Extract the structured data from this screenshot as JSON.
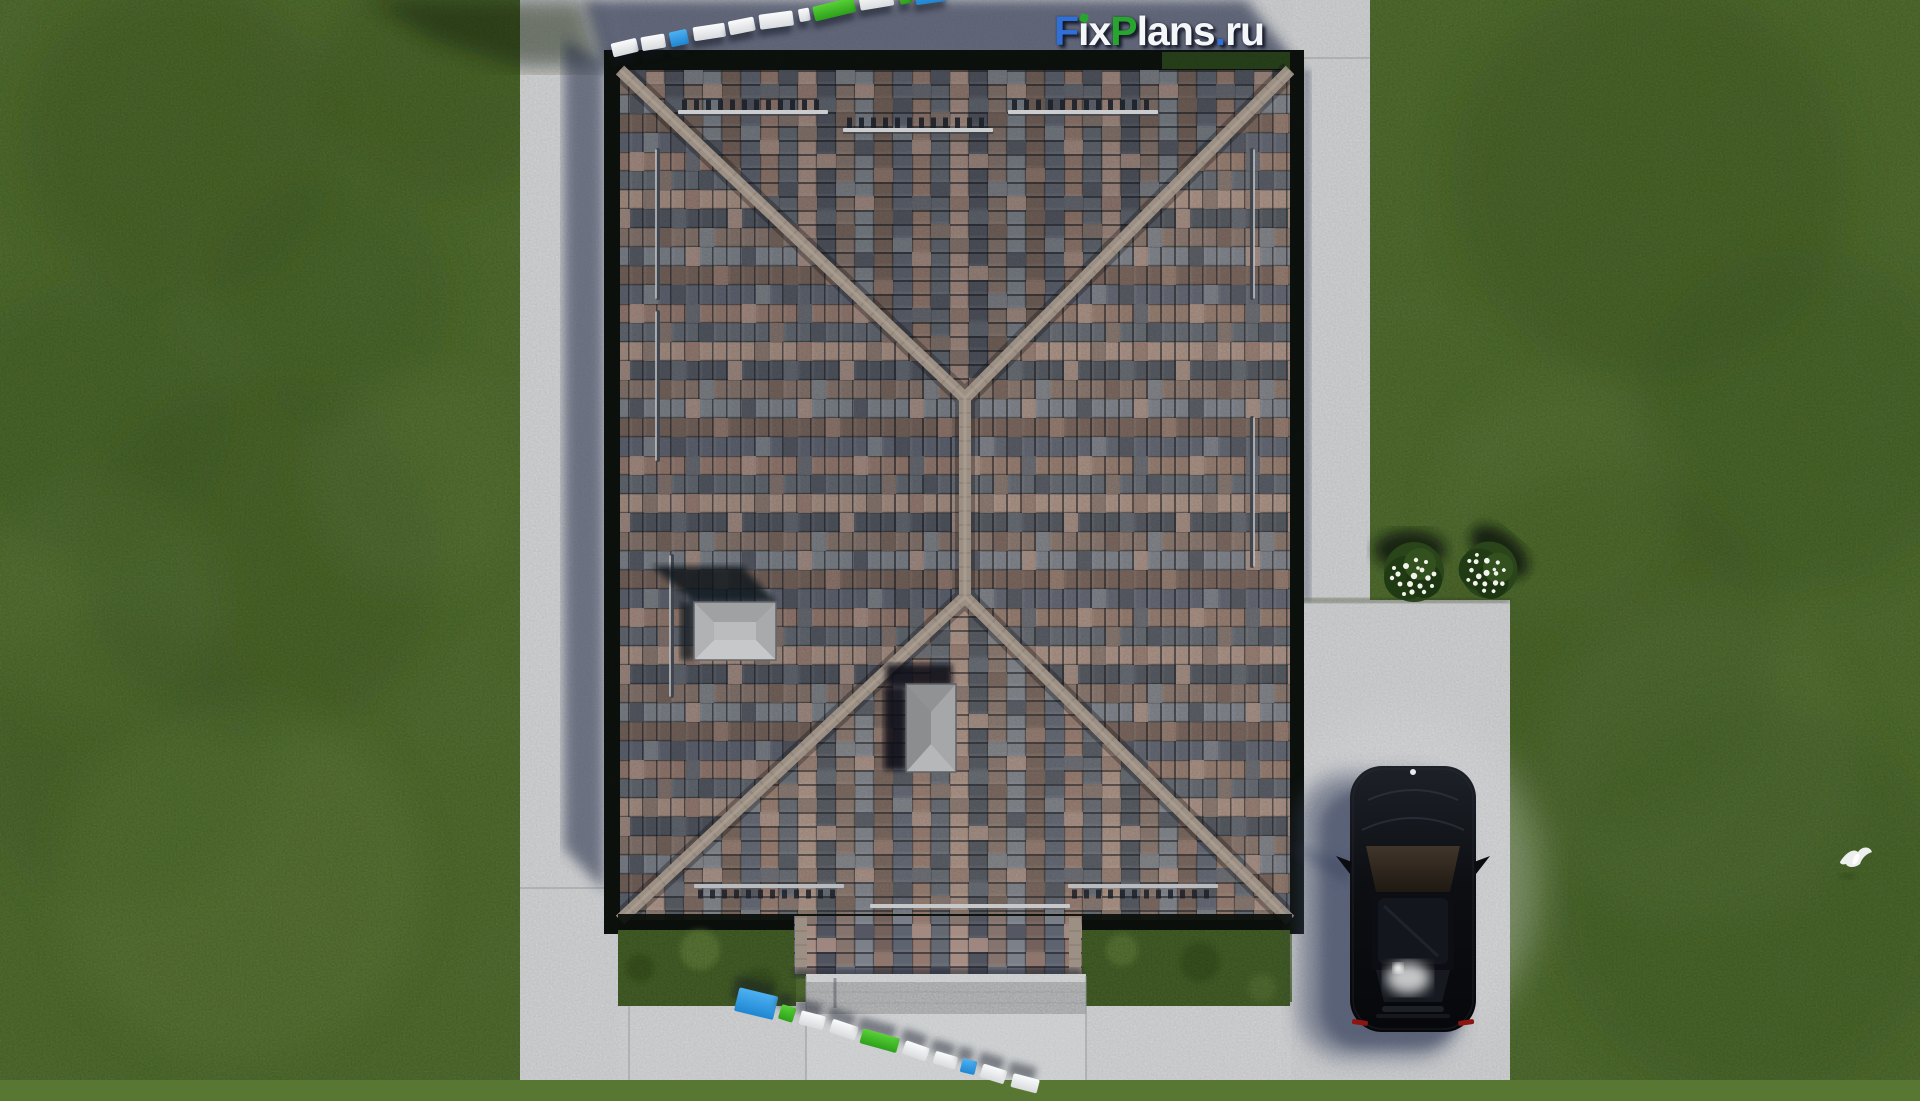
{
  "brand": {
    "logo_full_text": "FixPlans.ru",
    "logo_segments": [
      {
        "t": "F",
        "c": "#2f6fd8"
      },
      {
        "t": "i",
        "c": "#f4f6f8",
        "dot": "#27a62e"
      },
      {
        "t": "x",
        "c": "#f4f6f8"
      },
      {
        "t": "P",
        "c": "#27a62e"
      },
      {
        "t": "lans",
        "c": "#f4f6f8"
      },
      {
        "t": ".",
        "c": "#2f6fd8"
      },
      {
        "t": "ru",
        "c": "#f4f6f8"
      }
    ]
  },
  "palette": {
    "grass": "#587733",
    "grass_dark": "#3f5c24",
    "grass_light": "#6d8d45",
    "concrete": "#cdcfd1",
    "concrete_shadow": "#596078",
    "roof_ridge": "#9c9085",
    "roof_tiles": [
      "#9b7f73",
      "#696e76",
      "#b0968a",
      "#555962",
      "#8d7a71",
      "#848890",
      "#7b675e",
      "#646975"
    ],
    "car_body": "#0b0d11",
    "bar_blue": "#2f9fe8",
    "bar_green": "#47c32a",
    "bar_white": "#eef0f2"
  },
  "scene": {
    "view": "top-down aerial render of hip-roof house with driveway, lawn, parked black car, two flowering bushes, flying bird",
    "scale_bar_top": {
      "x": 612,
      "y": 38,
      "angle": -10.5,
      "gap": 4,
      "blocks": [
        {
          "c": "white",
          "w": 26,
          "h": 14
        },
        {
          "c": "white",
          "w": 24,
          "h": 14
        },
        {
          "c": "blue",
          "w": 18,
          "h": 15
        },
        {
          "c": "white",
          "w": 32,
          "h": 14
        },
        {
          "c": "white",
          "w": 26,
          "h": 14
        },
        {
          "c": "white",
          "w": 34,
          "h": 15
        },
        {
          "c": "white",
          "w": 11,
          "h": 13
        },
        {
          "c": "green",
          "w": 42,
          "h": 15
        },
        {
          "c": "white",
          "w": 34,
          "h": 14
        },
        {
          "c": "green",
          "w": 12,
          "h": 15
        },
        {
          "c": "blue",
          "w": 32,
          "h": 24
        }
      ]
    },
    "scale_bar_bottom": {
      "x": 737,
      "y": 986,
      "angle": 16.5,
      "gap": 5,
      "blocks": [
        {
          "c": "blue",
          "w": 40,
          "h": 24
        },
        {
          "c": "green",
          "w": 15,
          "h": 15
        },
        {
          "c": "white",
          "w": 25,
          "h": 14
        },
        {
          "c": "white",
          "w": 27,
          "h": 14
        },
        {
          "c": "green",
          "w": 38,
          "h": 15
        },
        {
          "c": "white",
          "w": 25,
          "h": 14
        },
        {
          "c": "white",
          "w": 23,
          "h": 13
        },
        {
          "c": "blue",
          "w": 15,
          "h": 14
        },
        {
          "c": "white",
          "w": 25,
          "h": 14
        },
        {
          "c": "white",
          "w": 27,
          "h": 14
        }
      ]
    }
  }
}
